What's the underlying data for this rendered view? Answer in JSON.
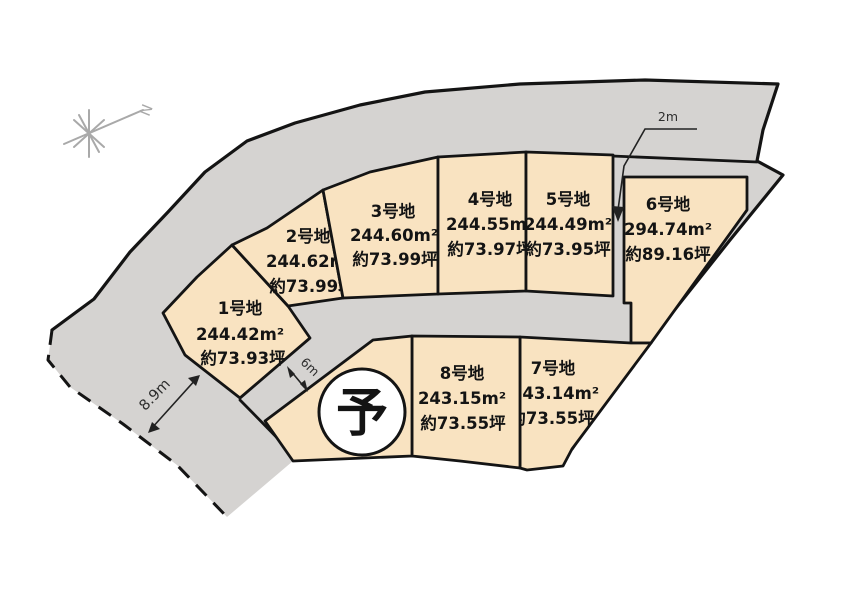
{
  "compass": {
    "north_label": "N"
  },
  "plots": [
    {
      "id": 1,
      "label": "1号地",
      "area": "244.42m²",
      "tsubo": "約73.93坪"
    },
    {
      "id": 2,
      "label": "2号地",
      "area": "244.62m²",
      "tsubo": "約73.99坪"
    },
    {
      "id": 3,
      "label": "3号地",
      "area": "244.60m²",
      "tsubo": "約73.99坪"
    },
    {
      "id": 4,
      "label": "4号地",
      "area": "244.55m²",
      "tsubo": "約73.97坪"
    },
    {
      "id": 5,
      "label": "5号地",
      "area": "244.49m²",
      "tsubo": "約73.95坪"
    },
    {
      "id": 6,
      "label": "6号地",
      "area": "294.74m²",
      "tsubo": "約89.16坪"
    },
    {
      "id": 7,
      "label": "7号地",
      "area": "243.14m²",
      "tsubo": "約73.55坪"
    },
    {
      "id": 8,
      "label": "8号地",
      "area": "243.15m²",
      "tsubo": "約73.55坪"
    }
  ],
  "reserved": {
    "mark": "予"
  },
  "dimensions": {
    "left_road_width": "8.9m",
    "inner_road_width": "6m",
    "strip_width": "2m"
  },
  "colors": {
    "plot_fill": "#f9e3c1",
    "road_fill": "#d5d3d1",
    "line": "#141414",
    "compass": "#a9a9a9"
  }
}
